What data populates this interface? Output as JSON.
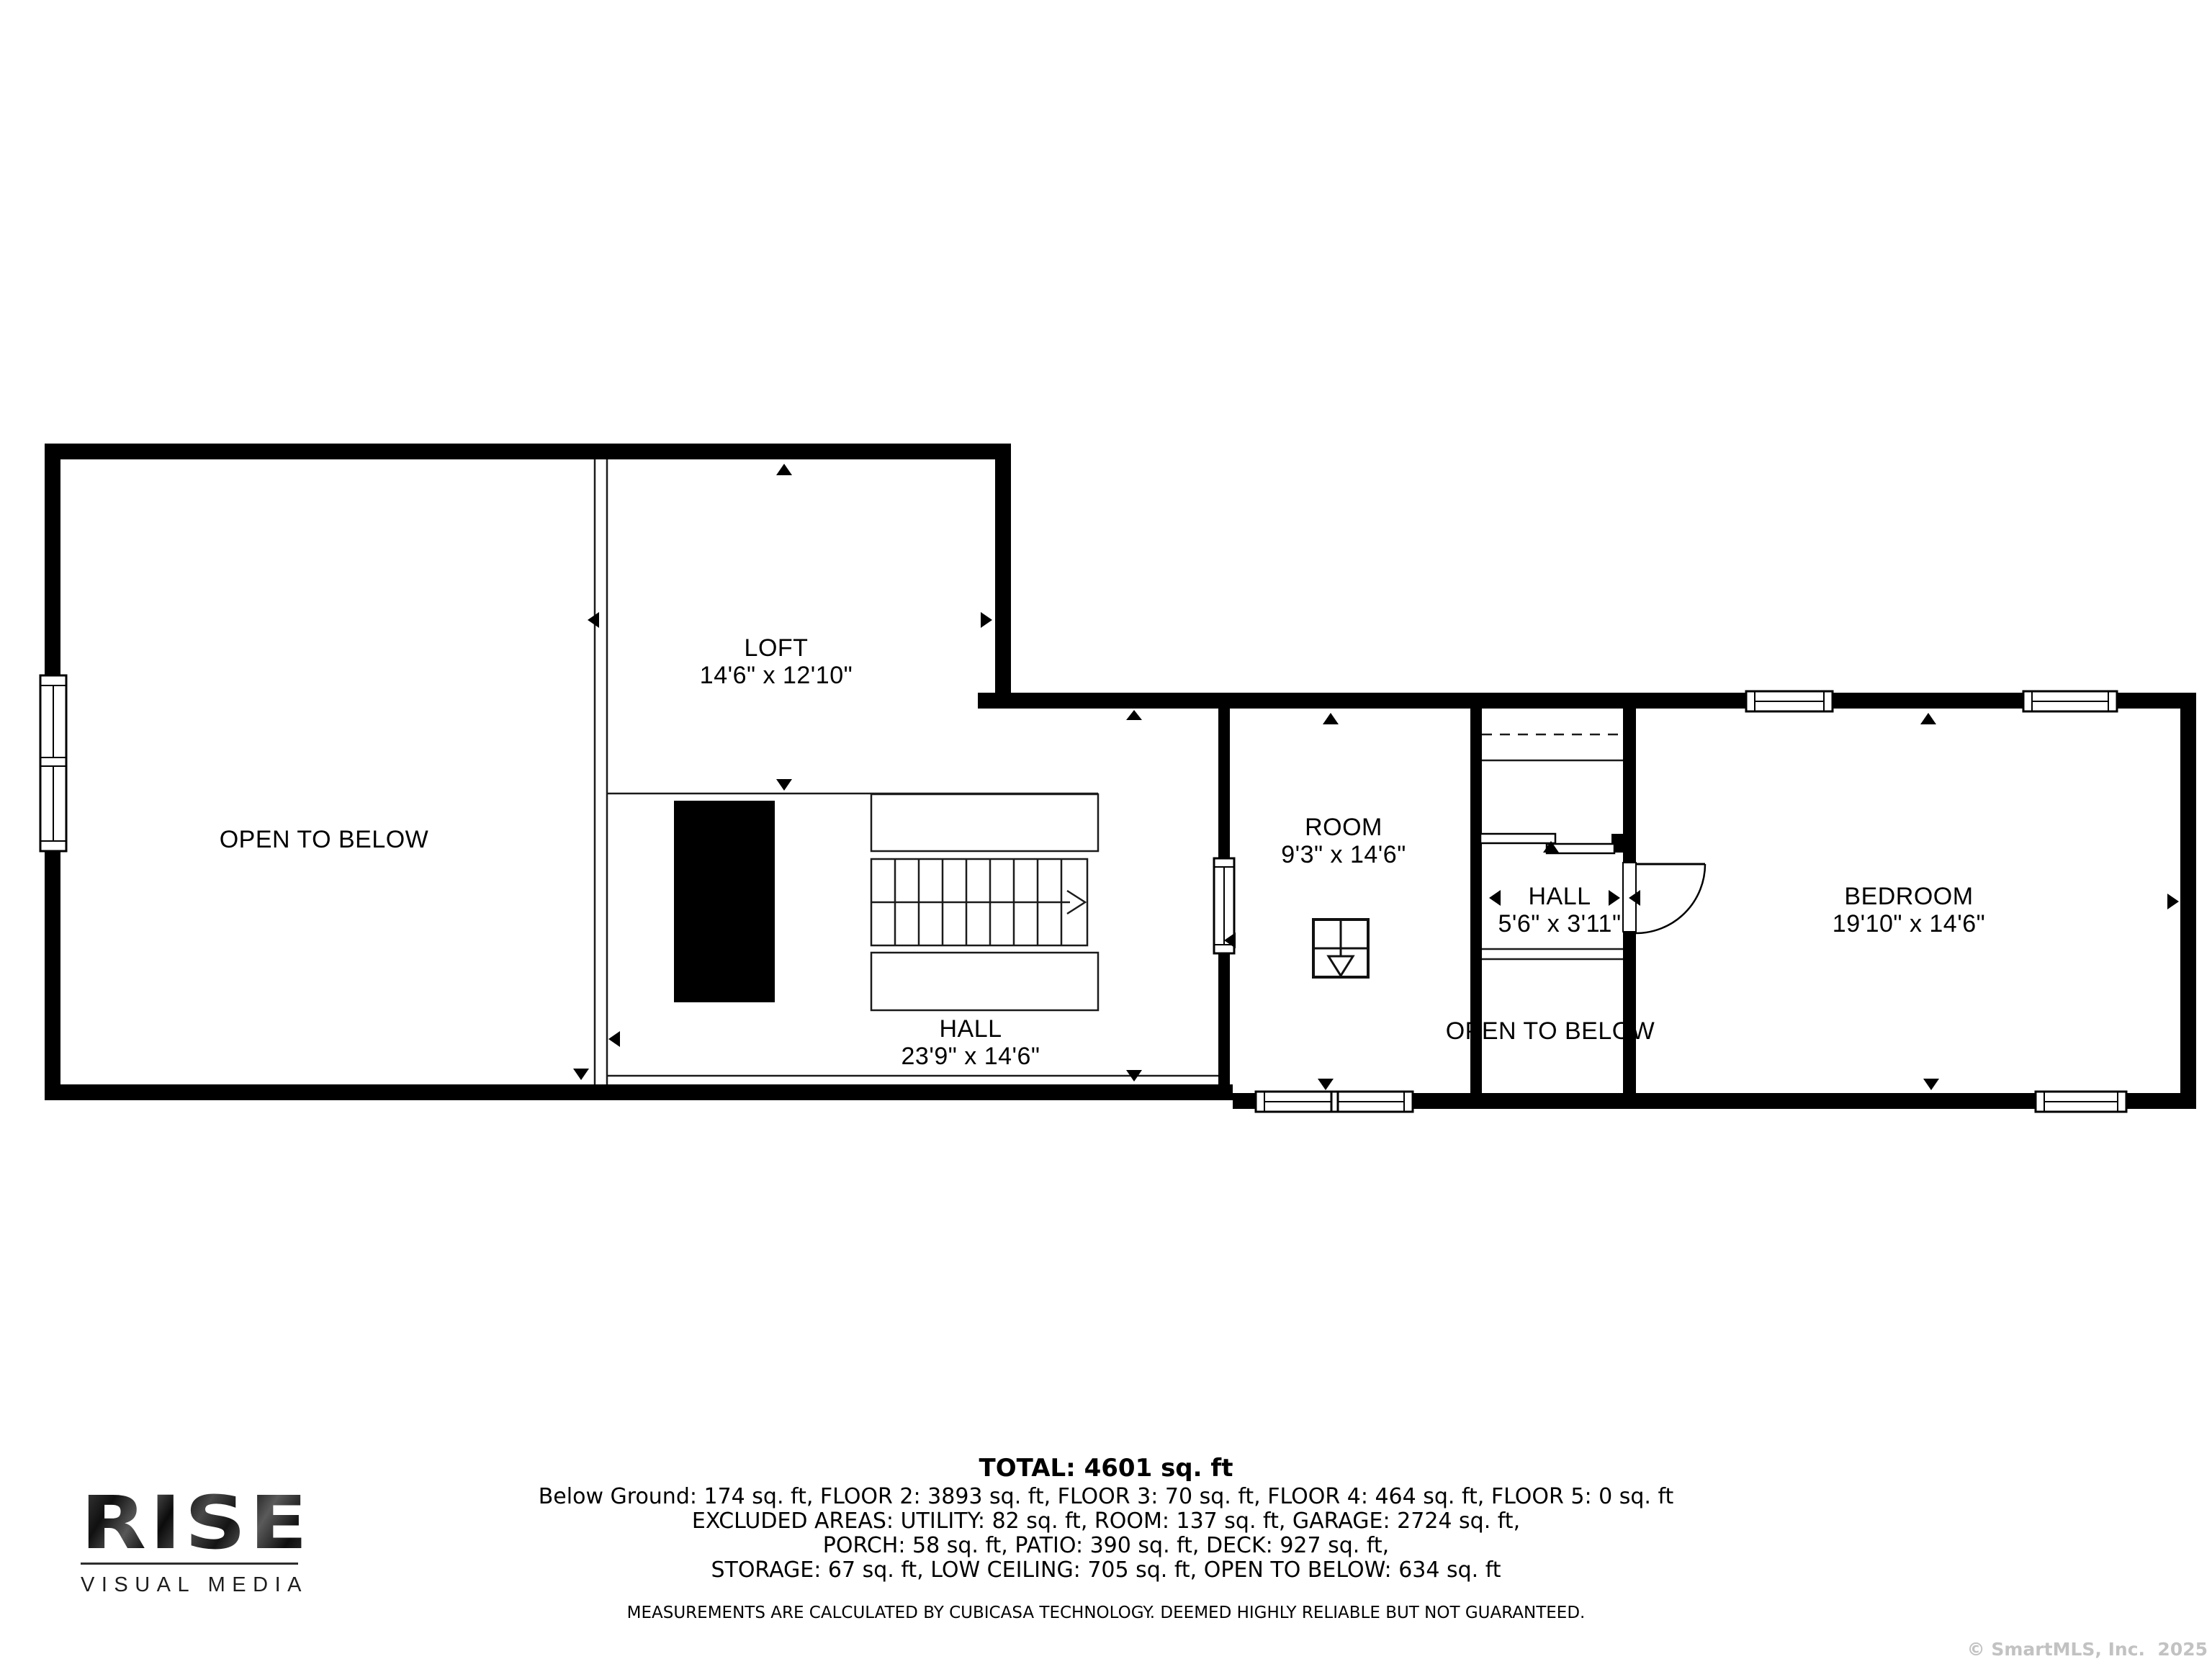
{
  "plan": {
    "rooms": {
      "loft": {
        "name": "LOFT",
        "dims": "14'6\" x 12'10\""
      },
      "open_to_below_main": {
        "name": "OPEN TO BELOW"
      },
      "hall_main": {
        "name": "HALL",
        "dims": "23'9\" x 14'6\""
      },
      "room": {
        "name": "ROOM",
        "dims": "9'3\" x 14'6\""
      },
      "hall_small": {
        "name": "HALL",
        "dims": "5'6\" x 3'11\""
      },
      "open_to_below_small": {
        "name": "OPEN TO BELOW"
      },
      "bedroom": {
        "name": "BEDROOM",
        "dims": "19'10\" x 14'6\""
      }
    }
  },
  "summary": {
    "total": "TOTAL: 4601 sq. ft",
    "line1": "Below Ground: 174 sq. ft, FLOOR 2: 3893 sq. ft, FLOOR 3: 70 sq. ft, FLOOR 4: 464 sq. ft, FLOOR 5: 0 sq. ft",
    "line2": "EXCLUDED AREAS: UTILITY: 82 sq. ft, ROOM: 137 sq. ft, GARAGE: 2724 sq. ft,",
    "line3": "PORCH: 58 sq. ft, PATIO: 390 sq. ft, DECK: 927 sq. ft,",
    "line4": "STORAGE: 67 sq. ft, LOW CEILING: 705 sq. ft, OPEN TO BELOW: 634 sq. ft",
    "disclaimer": "MEASUREMENTS ARE CALCULATED BY CUBICASA TECHNOLOGY. DEEMED HIGHLY RELIABLE BUT NOT GUARANTEED."
  },
  "branding": {
    "logo_text": "RISE",
    "logo_tagline": "VISUAL MEDIA"
  },
  "footer": {
    "copyright": "© SmartMLS, Inc.  2025"
  },
  "colors": {
    "wall": "#000000",
    "thin_line": "#1b1b1b",
    "background": "#ffffff",
    "copyright_gray": "#c2c2c2"
  }
}
